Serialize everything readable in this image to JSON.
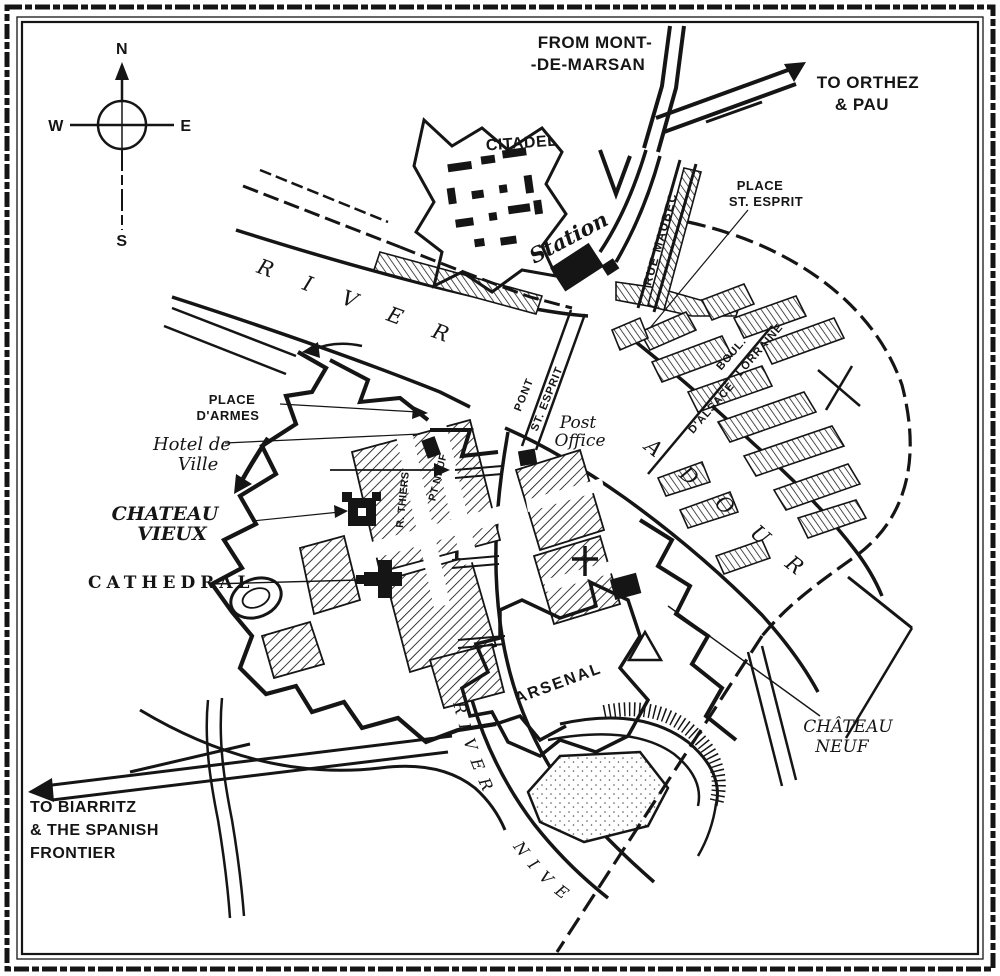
{
  "map": {
    "title_hint": "city plan",
    "colors": {
      "ink": "#151515",
      "paper": "#ffffff"
    },
    "compass": {
      "n": "N",
      "e": "E",
      "s": "S",
      "w": "W"
    },
    "labels": {
      "from_mont_line1": "FROM MONT-",
      "from_mont_line2": "-DE-MARSAN",
      "to_orthez_line1": "TO ORTHEZ",
      "to_orthez_line2": "& PAU",
      "citadel": "CITADEL",
      "station": "Station",
      "rue_maubec": "RUE MAUBEC",
      "place_st_esprit_line1": "PLACE",
      "place_st_esprit_line2": "ST. ESPRIT",
      "river": "RIVER",
      "adour": "ADOUR",
      "nive": "NIVE",
      "place_darmes_line1": "PLACE",
      "place_darmes_line2": "D'ARMES",
      "hotel_de_ville_line1": "Hotel de",
      "hotel_de_ville_line2": "Ville",
      "chateau_vieux_line1": "CHATEAU",
      "chateau_vieux_line2": "VIEUX",
      "cathedral": "CATHEDRAL",
      "pont": "PONT",
      "pont_st_esprit": "ST. ESPRIT",
      "post_office_line1": "Post",
      "post_office_line2": "Office",
      "boul": "BOUL.",
      "dalsace": "D'ALSACE",
      "lorraine": "LORRAINE",
      "rue_thiers": "R. THIERS",
      "pont_neuf": "PT NEUF",
      "arsenal": "ARSENAL",
      "chateau_neuf_line1": "CHÂTEAU",
      "chateau_neuf_line2": "NEUF",
      "to_biarritz_line1": "TO BIARRITZ",
      "to_biarritz_line2": "& THE SPANISH",
      "to_biarritz_line3": "FRONTIER"
    }
  }
}
